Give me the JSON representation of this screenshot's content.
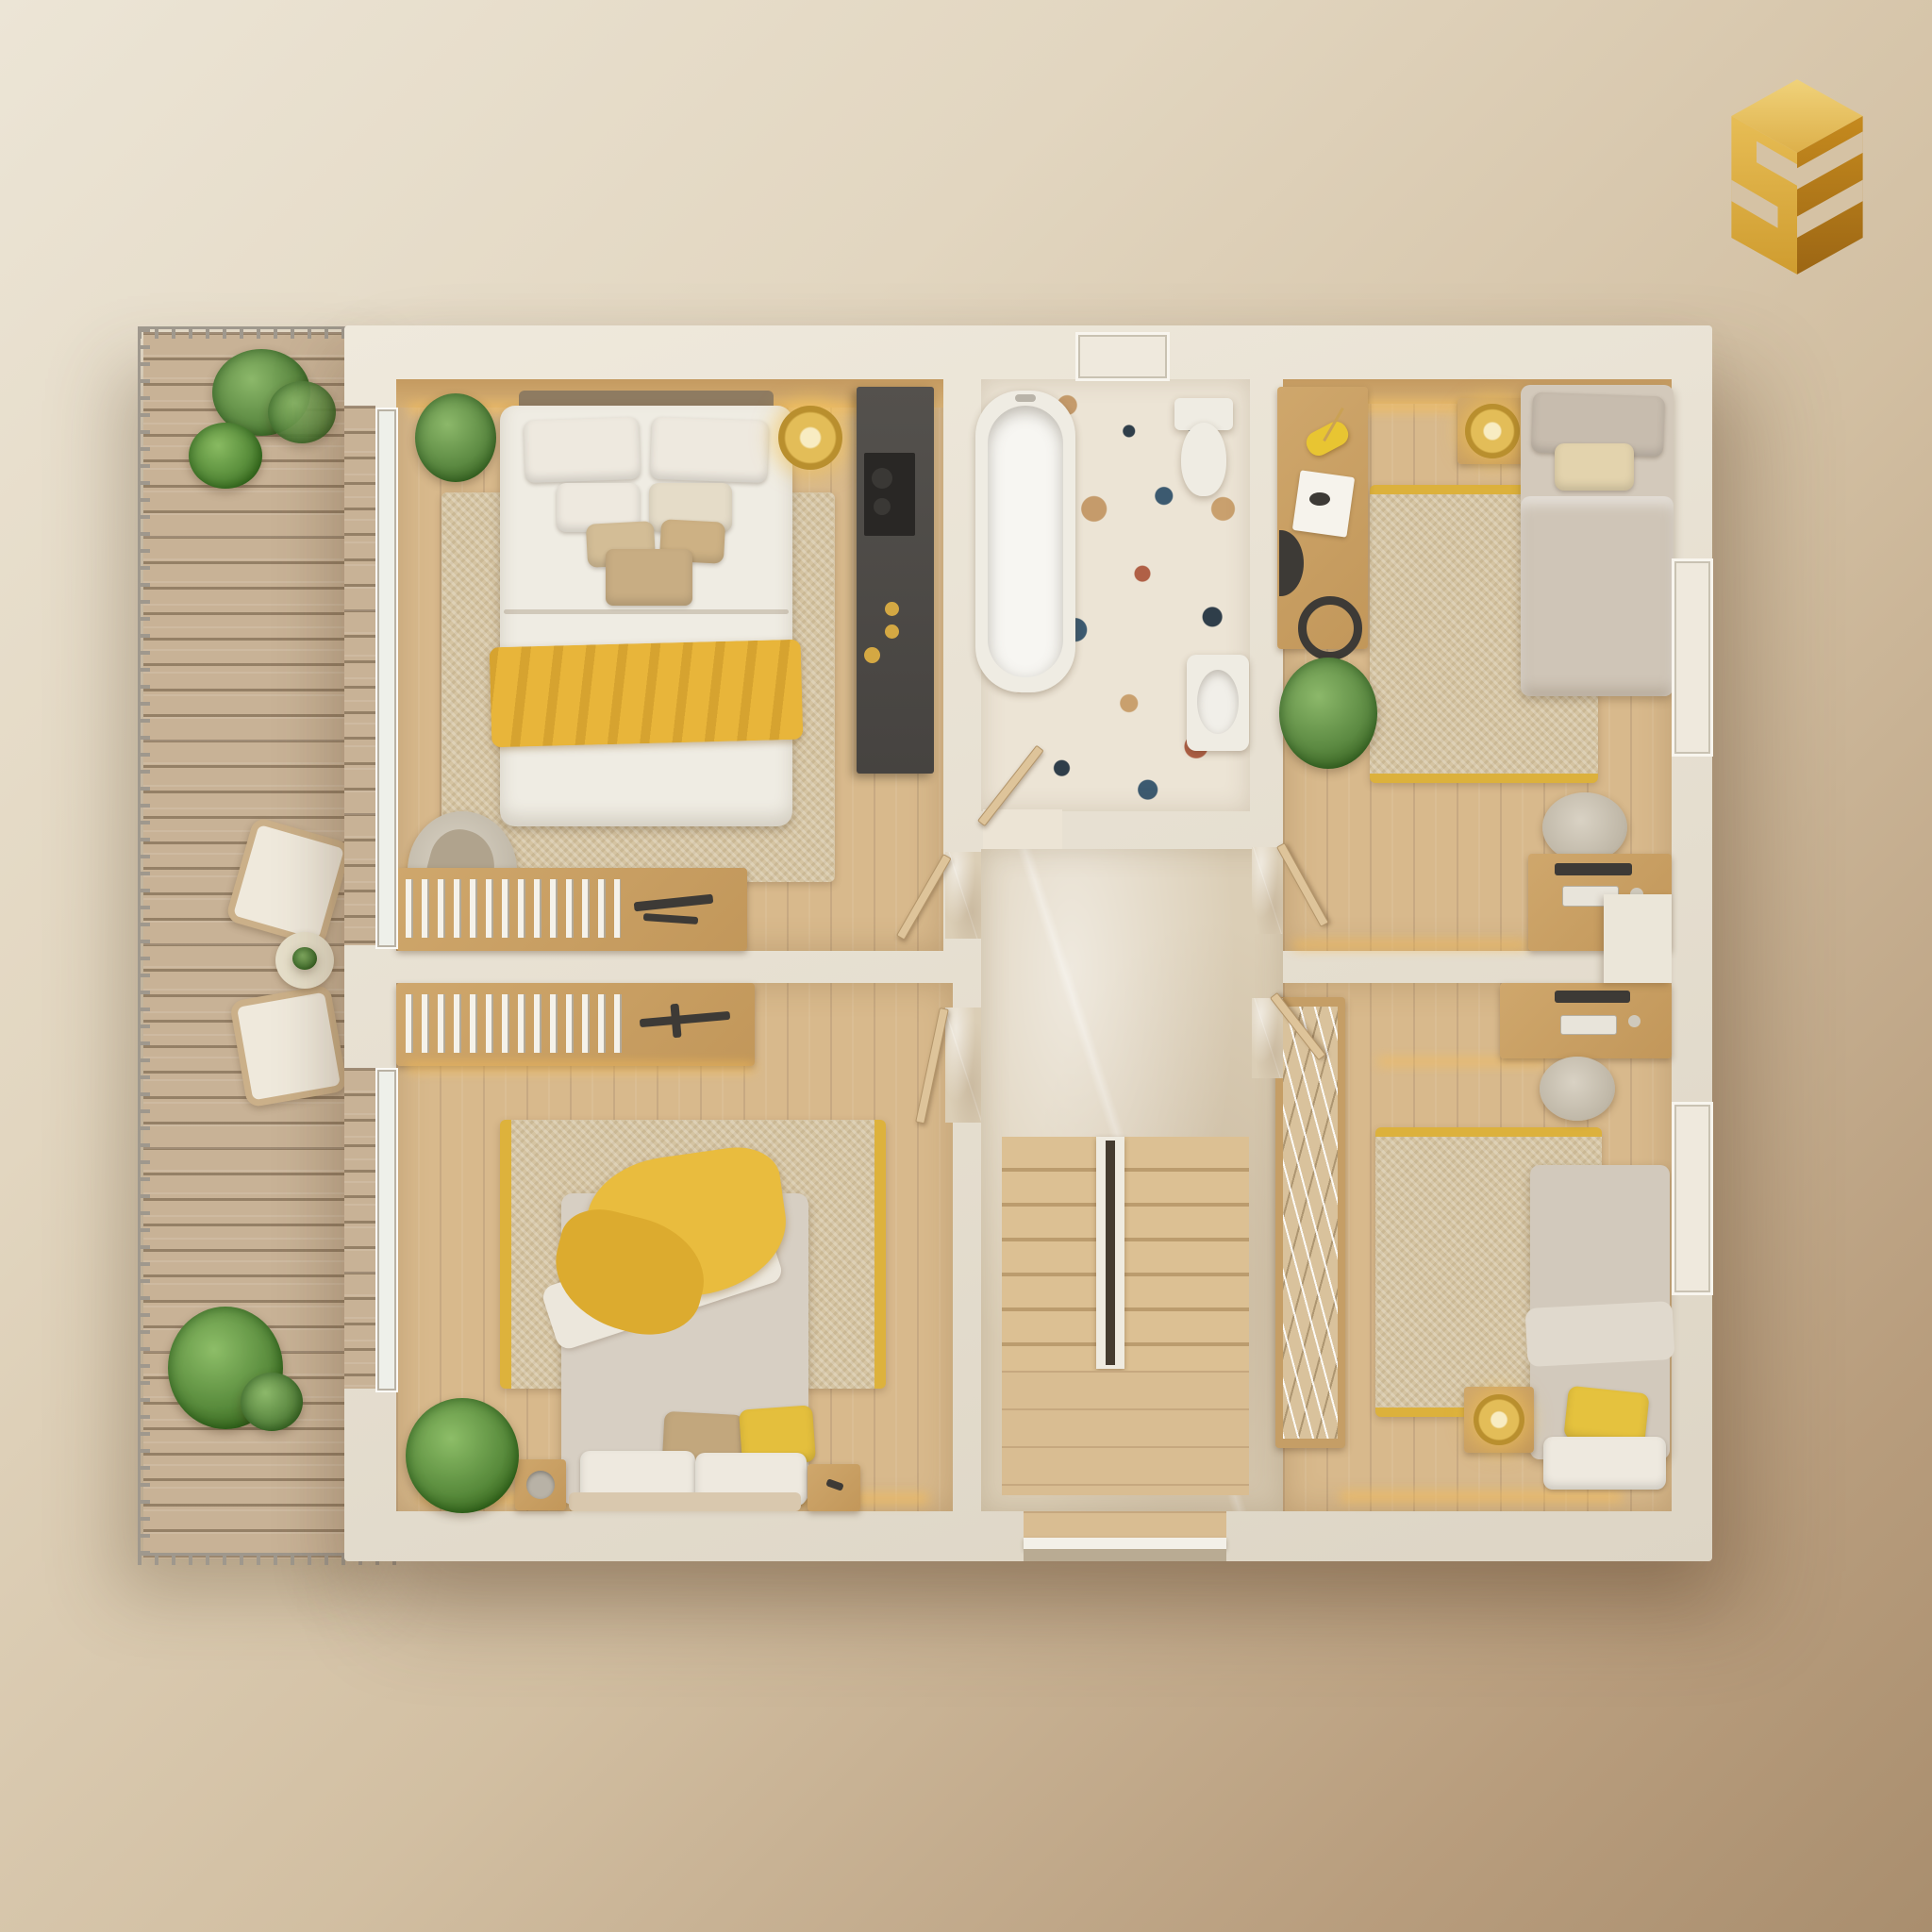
{
  "meta": {
    "type": "3d-floor-plan-render",
    "view": "top-down isometric dollhouse render",
    "floor": "upper floor of a home, warm beige palette with yellow accents"
  },
  "logo": {
    "label": "gold isometric cube logo with carved S and triple-bar motif",
    "color_light": "#e8c35c",
    "color_mid": "#d3a139",
    "color_dark": "#a97417"
  },
  "palette": {
    "background_top_left": "#ece5d6",
    "background_bottom_right": "#a98e6e",
    "walls": "#e8e2d5",
    "wood_floor": "#d8b98c",
    "deck_wood": "#c8b296",
    "marble_hall": "#dbceb6",
    "rug_jute": "#d5c4a2",
    "accent_yellow": "#e6b83c",
    "gold": "#d2a94e",
    "dark_wardrobe": "#4e4b47",
    "greenery": "#5c8a42",
    "terrazzo_base": "#ece4d5",
    "terrazzo_chips": [
      "#b06046",
      "#c59b6b",
      "#3c5a70",
      "#2f3e4a"
    ]
  },
  "rooms": {
    "terrace": {
      "label": "Terrace deck with metal railing",
      "items": [
        "leafy potted plant",
        "round bush plant",
        "fern plant",
        "two wicker lounge chairs with white cushions",
        "round side table with small plant"
      ]
    },
    "master_bedroom": {
      "label": "Master bedroom",
      "items": [
        "double bed with white duvet and yellow throw",
        "layered white and tan pillows",
        "wood headboard wall with LED strip",
        "jute rug",
        "potted plant",
        "gold pendant disc lamp",
        "dark gray wardrobe with gold handles",
        "round armchair with blanket",
        "low bookshelf and desk with decor"
      ]
    },
    "bathroom": {
      "label": "Bathroom with terrazzo floor",
      "items": [
        "freestanding bathtub",
        "toilet",
        "bidet",
        "swing door",
        "window"
      ]
    },
    "bedroom_top_right": {
      "label": "Bedroom, top right",
      "items": [
        "single bed with gray bedding",
        "desk with yellow lamp, papers, monitor and headphones",
        "nightstand with glowing gold ring lamp",
        "jute rug with yellow border",
        "potted plant",
        "second desk with keyboard and office chair",
        "window"
      ]
    },
    "bedroom_bottom_left": {
      "label": "Bedroom, bottom left",
      "items": [
        "double bed with draped yellow throw",
        "tan, yellow and white pillows",
        "low bookshelf with model airplane",
        "jute rug with yellow side borders",
        "fern plant",
        "two wood nightstands"
      ]
    },
    "bedroom_bottom_right": {
      "label": "Bedroom, bottom right",
      "items": [
        "single bed with gray duvet and yellow pillow",
        "open wardrobe rack with hanging clothes",
        "desk with monitor, keyboard and office chair",
        "jute rug with yellow border",
        "nightstand with gold disc lamp",
        "window"
      ]
    },
    "hallway": {
      "label": "Hallway with U-shaped staircase",
      "items": [
        "beige marble floor",
        "wood stairs with central divider rail",
        "landing",
        "four swing doors",
        "bottom threshold opening"
      ]
    }
  }
}
